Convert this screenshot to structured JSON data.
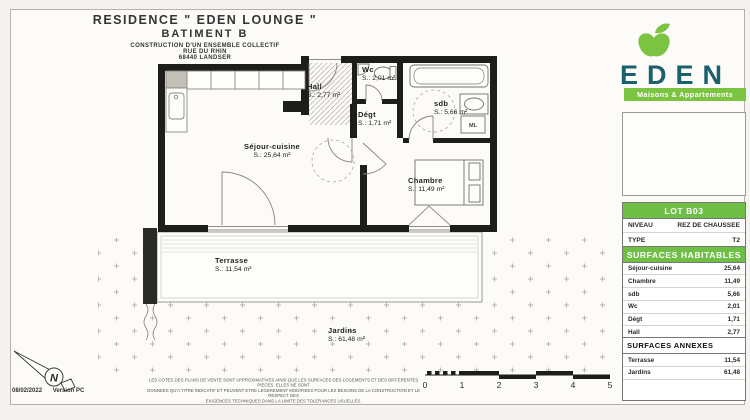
{
  "document": {
    "title_line1": "RESIDENCE \" EDEN LOUNGE \"",
    "title_line2": "BATIMENT B",
    "subtitle_line1": "CONSTRUCTION D'UN ENSEMBLE COLLECTIF",
    "subtitle_line2": "RUE DU RHIN",
    "subtitle_line3": "68440 LANDSER",
    "date": "08/02/2022",
    "version": "Version PC",
    "north_letter": "N",
    "disclaimer_line1": "LES COTES DES PLANS DE VENTE SONT APPROXIMATIVES AINSI QUE LES SURFACES DES LOGEMENTS ET DES DIFFERENTES PIECES. ELLES NE SONT",
    "disclaimer_line2": "DONNEES QU'A TITRE INDICATIF ET PEUVENT ETRE LEGEREMENT MODIFIEES POUR LES BESOINS DE LA CONSTRUCTION ET LE RESPECT DES",
    "disclaimer_line3": "EXIGENCES TECHNIQUES DANS LA LIMITE DES TOLERANCES USUELLES."
  },
  "plan": {
    "rooms": {
      "sejour": {
        "name": "Séjour-cuisine",
        "area": "S.: 25,64 m²"
      },
      "chambre": {
        "name": "Chambre",
        "area": "S.: 11,49 m²"
      },
      "hall": {
        "name": "Hall",
        "area": "S.: 2,77 m²"
      },
      "degt": {
        "name": "Dégt",
        "area": "S.: 1,71 m²"
      },
      "wc": {
        "name": "Wc",
        "area": "S.: 2,01 m²"
      },
      "sdb": {
        "name": "sdb",
        "area": "S.: 5,66 m²"
      },
      "terrasse": {
        "name": "Terrasse",
        "area": "S.: 11,54 m²"
      },
      "jardins": {
        "name": "Jardins",
        "area": "S.: 61,48 m²"
      }
    },
    "washing_machine_label": "ML",
    "scale_ticks": [
      "0",
      "1",
      "2",
      "3",
      "4",
      "5"
    ]
  },
  "brand": {
    "name": "EDEN",
    "tagline": "Maisons & Appartements",
    "colors": {
      "green": "#7cc342",
      "teal": "#19616d"
    }
  },
  "lot": {
    "header": "LOT B03",
    "rows": [
      {
        "label": "NIVEAU",
        "value": "REZ DE CHAUSSEE"
      },
      {
        "label": "TYPE",
        "value": "T2"
      }
    ]
  },
  "surfaces_habitables": {
    "header": "SURFACES HABITABLES",
    "rows": [
      {
        "label": "Séjour-cuisine",
        "value": "25,64"
      },
      {
        "label": "Chambre",
        "value": "11,49"
      },
      {
        "label": "sdb",
        "value": "5,66"
      },
      {
        "label": "Wc",
        "value": "2,01"
      },
      {
        "label": "Dégt",
        "value": "1,71"
      },
      {
        "label": "Hall",
        "value": "2,77"
      }
    ],
    "total": "49,28 m²"
  },
  "surfaces_annexes": {
    "header": "SURFACES ANNEXES",
    "rows": [
      {
        "label": "Terrasse",
        "value": "11,54"
      },
      {
        "label": "Jardins",
        "value": "61,48"
      }
    ]
  }
}
